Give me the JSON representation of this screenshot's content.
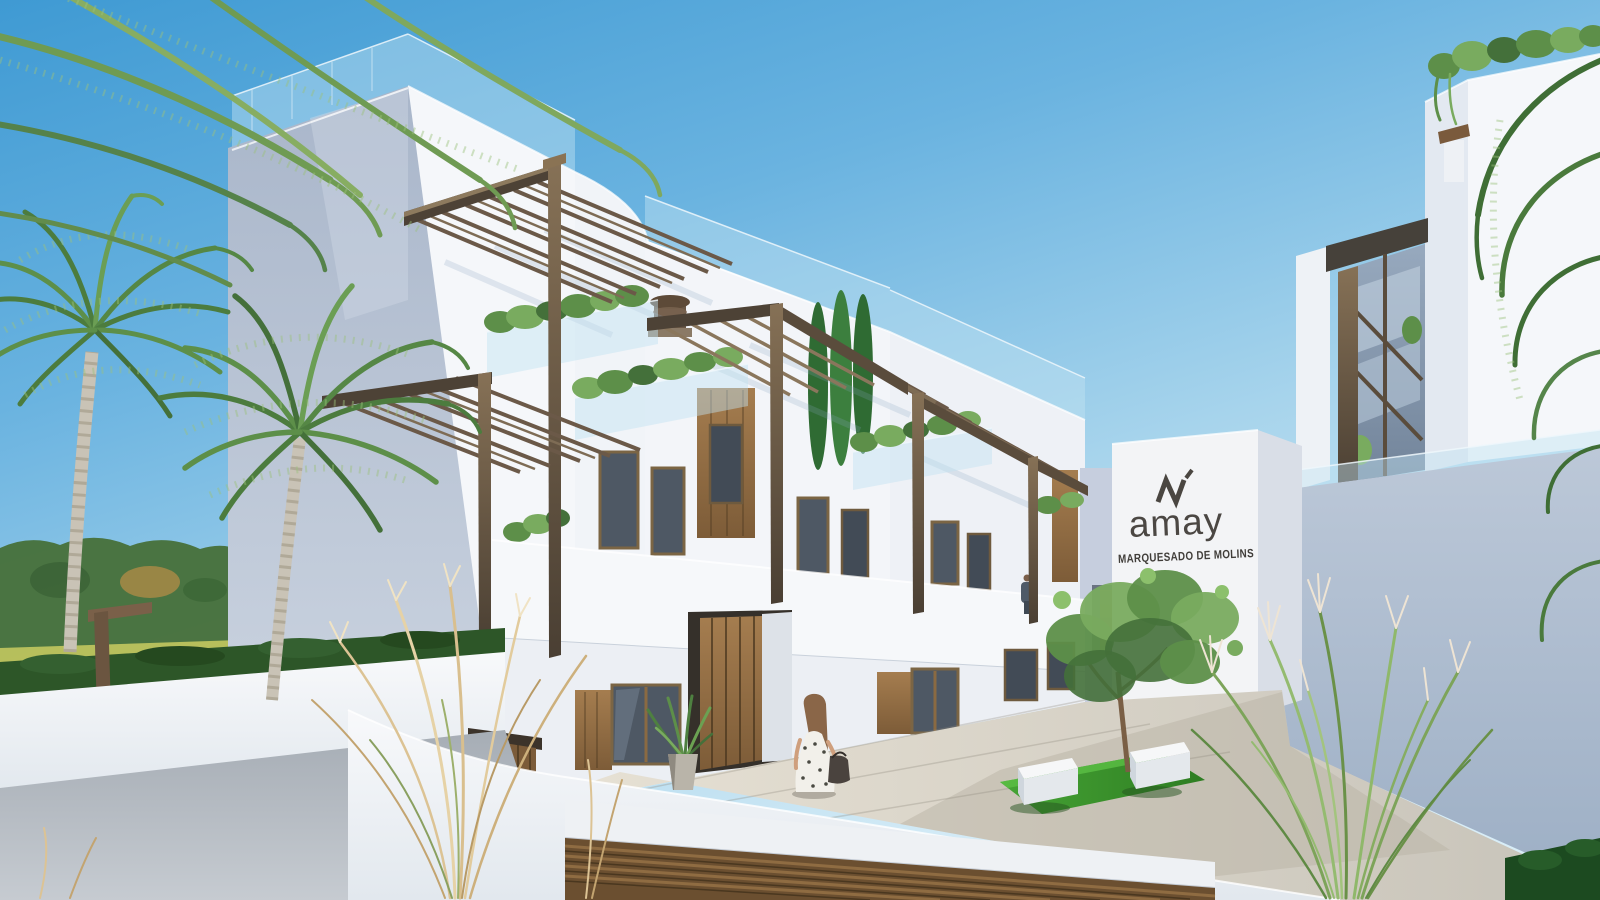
{
  "image": {
    "kind": "3D architectural exterior rendering",
    "description": "Modern white Mediterranean apartment complex with bronze pergolas, roof terraces, palm trees and a landscaped courtyard under a clear blue sky"
  },
  "sign": {
    "brand": "amay",
    "development": "MARQUESADO DE MOLINS"
  },
  "palette": {
    "sky_top": "#3f9ad3",
    "sky_horizon": "#d8edf7",
    "wall_lit": "#f4f6f9",
    "wall_shaded": "#b6c2d4",
    "pergola_bronze": "#6b5944",
    "wood": "#96713f",
    "lawn": "#3f9b2f",
    "field": "#b9bf55",
    "hedge": "#2d5628"
  },
  "scene": {
    "landmarks": [
      "left roof-terrace tower",
      "stepped townhouse terraces",
      "brand sign wall",
      "right building with pergola",
      "courtyard with lawn and white benches",
      "underground garage entrance"
    ],
    "vegetation": [
      "palm trees",
      "cypress trees",
      "balcony planters",
      "courtyard tree",
      "ornamental grasses",
      "perimeter hedge"
    ],
    "figures": [
      "woman with handbag at the entrance",
      "resident on the upper walkway"
    ]
  }
}
